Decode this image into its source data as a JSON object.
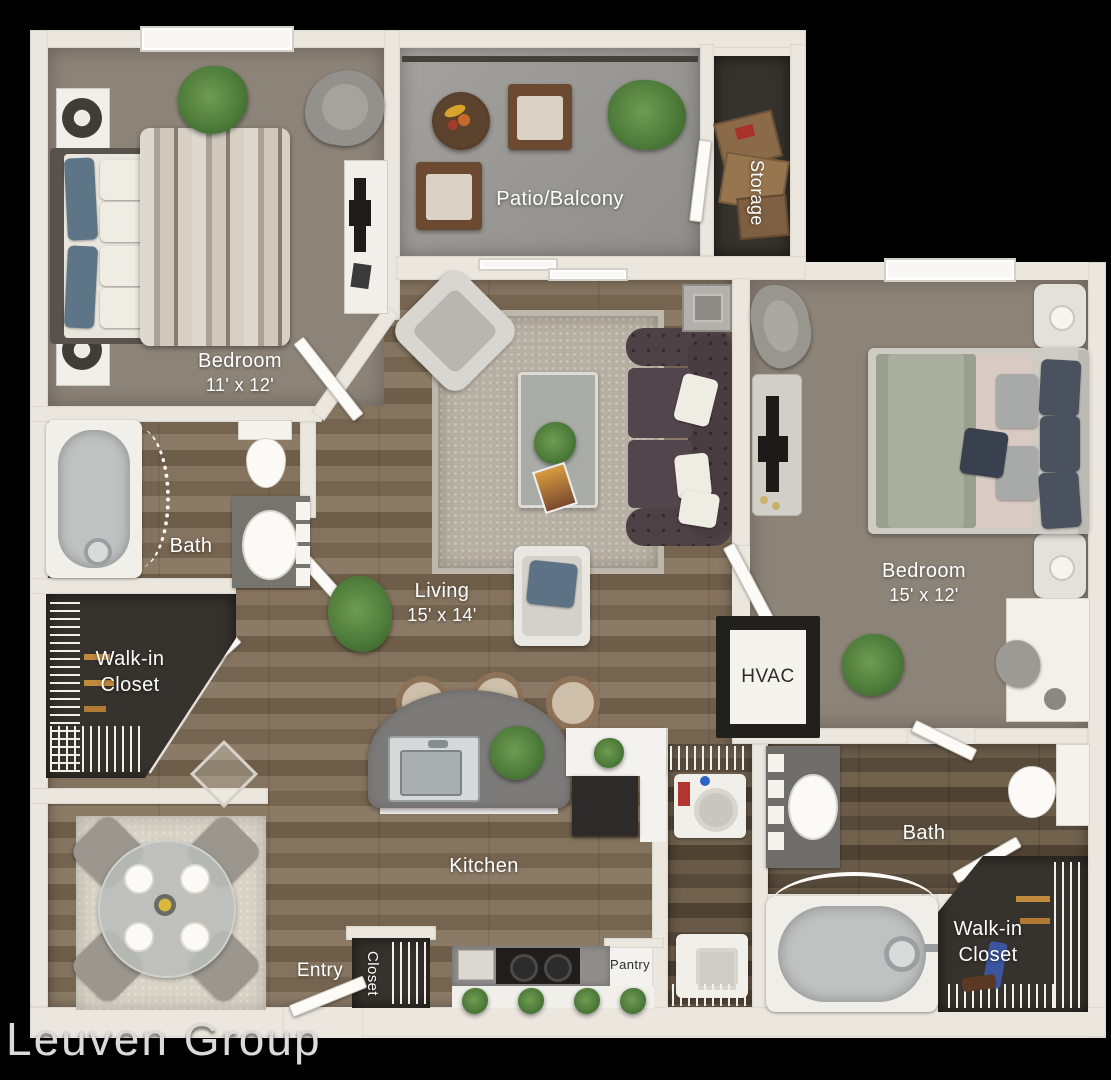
{
  "watermark": "Leuven Group",
  "rooms": {
    "bedroom_top_left": {
      "label": "Bedroom",
      "dims": "11' x 12'"
    },
    "patio": {
      "label": "Patio/Balcony"
    },
    "storage": {
      "label": "Storage"
    },
    "bedroom_right": {
      "label": "Bedroom",
      "dims": "15' x 12'"
    },
    "bath_left": {
      "label": "Bath"
    },
    "walkin_left": {
      "line1": "Walk-in",
      "line2": "Closet"
    },
    "living": {
      "label": "Living",
      "dims": "15' x 14'"
    },
    "hvac": {
      "label": "HVAC"
    },
    "kitchen": {
      "label": "Kitchen"
    },
    "entry": {
      "label": "Entry"
    },
    "entry_closet": {
      "label": "Closet"
    },
    "pantry": {
      "label": "Pantry"
    },
    "bath_right": {
      "label": "Bath"
    },
    "walkin_right": {
      "line1": "Walk-in",
      "line2": "Closet"
    }
  },
  "colors": {
    "bg": "#000000",
    "wall": "#ebe7df",
    "carpet": "#8d8479",
    "concrete": "#9e9d99",
    "dark_floor": "#36322d",
    "door": "#fcfbf8",
    "island": "#7c7b79",
    "counter": "#8f8e8c",
    "cabinet_black": "#2d2b29",
    "sofa": "#473b3f",
    "tub": "#bfc2c1",
    "rug": "#b6afa3",
    "dining_rug": "#d9d3c7",
    "plant_green": "#4f7d3b",
    "label_white": "#ffffff",
    "label_dark": "#2e2c29",
    "watermark": "#dcdad6"
  }
}
